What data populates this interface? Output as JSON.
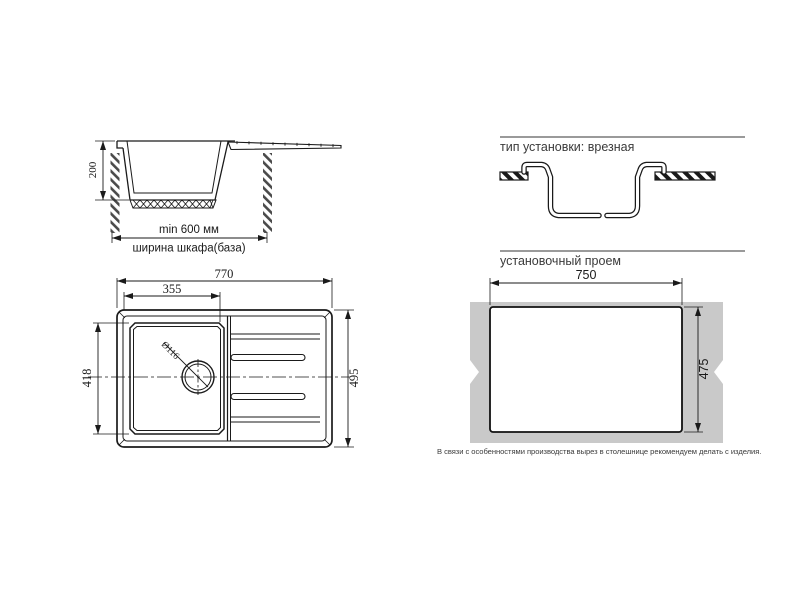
{
  "side_view": {
    "depth": "200",
    "min_width": "min 600 мм",
    "cabinet": "ширина шкафа(база)"
  },
  "install_type": {
    "header": "тип установки: врезная"
  },
  "plan_view": {
    "overall_width": "770",
    "bowl_width": "355",
    "bowl_depth": "418",
    "overall_depth": "495",
    "drain_diameter": "Ø116"
  },
  "cutout": {
    "header": "установочный проем",
    "width": "750",
    "height": "475",
    "note": "В связи с особенностями производства вырез в столешнице рекомендуем делать с изделия."
  },
  "colors": {
    "line": "#1a1a1a",
    "rule": "#9a9a9a",
    "countertop": "#c9c9c9"
  }
}
